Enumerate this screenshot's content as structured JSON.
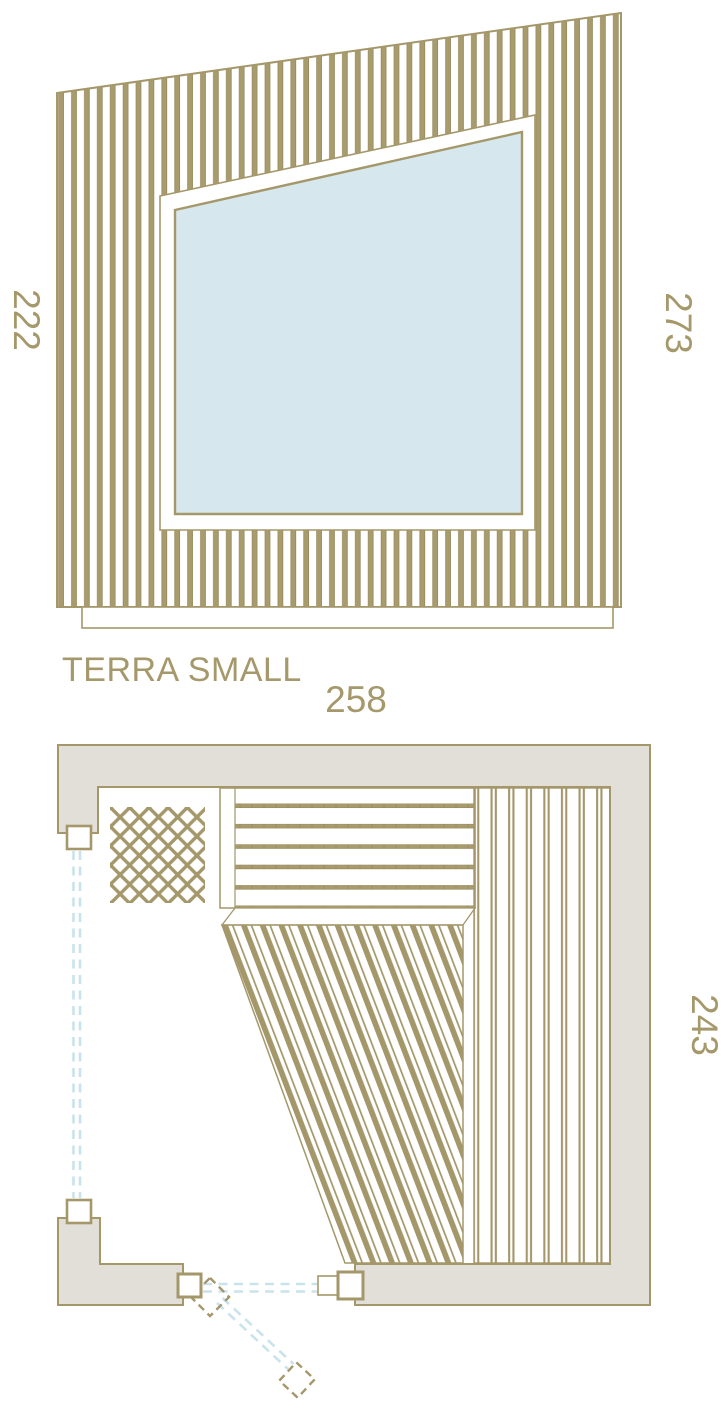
{
  "title": "TERRA SMALL",
  "elevation": {
    "dim_left": "222",
    "dim_right": "273"
  },
  "plan": {
    "dim_top": "258",
    "dim_right": "243"
  },
  "colors": {
    "line": "#A4976A",
    "slat_fill": "#A89B6C",
    "wall_fill": "#E2DFD8",
    "window_glass": "#D6E7ED",
    "glass_dashed": "#C9E3EC",
    "label_text": "#A5986B",
    "background": "#FFFFFF"
  }
}
